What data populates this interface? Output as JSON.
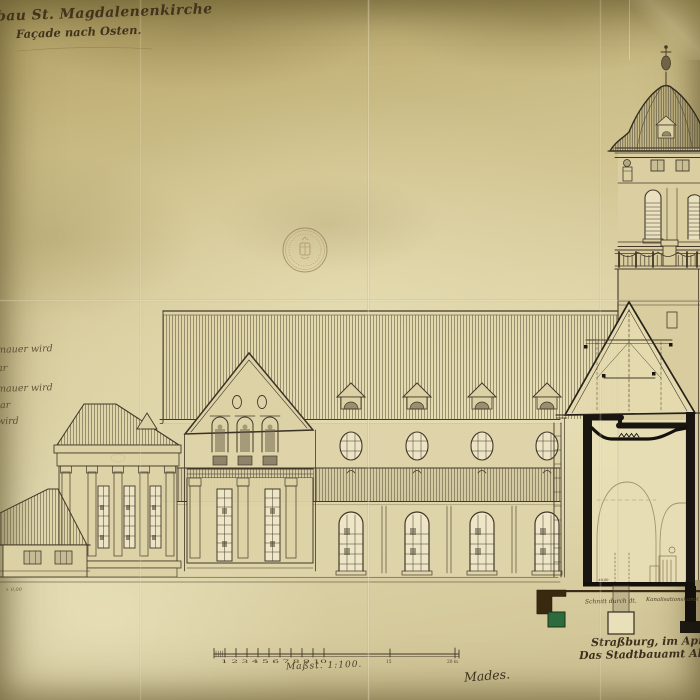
{
  "sheet": {
    "title_line1": "bau St. Magdalenenkirche",
    "title_line2": "Façade nach Osten.",
    "margin_notes": [
      "mauer wird",
      "ar",
      "mauer wird",
      "lar",
      "wird"
    ],
    "scale": {
      "label": "Maßst. 1:100.",
      "numbers": "1 2 3 4 5 6 7 8 9 10",
      "mid": "15",
      "end": "20 m"
    },
    "signature": "Mades.",
    "footer": {
      "place_date": "Straßburg, im April 1",
      "office": "Das Stadtbauamt Ab"
    },
    "section_notes": {
      "left": "Schnitt durch dt.",
      "right": "Kanalisationskanal"
    },
    "marks": {
      "ground": "+ 0,00",
      "floor": "±0,00"
    },
    "stamp": "official-round-seal",
    "colors": {
      "paper": "#d8cc9e",
      "ink": "#43392a",
      "foundation_green": "#2e6b3c",
      "foundation_brown": "#38290f"
    }
  }
}
